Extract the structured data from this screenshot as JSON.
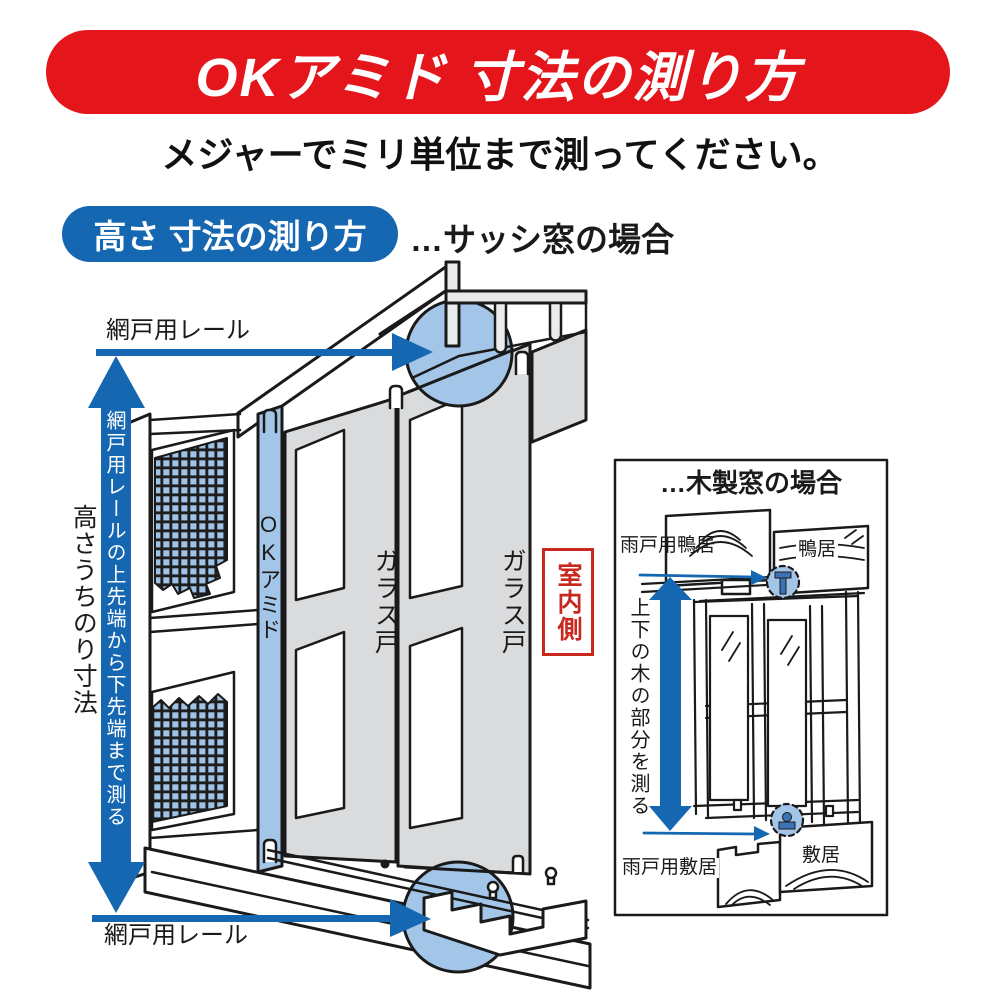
{
  "header": {
    "title": "OKアミド 寸法の測り方",
    "subtitle": "メジャーでミリ単位まで測ってください。"
  },
  "section": {
    "badge": "高さ 寸法の測り方",
    "case_label": "…サッシ窓の場合"
  },
  "sash": {
    "rail_label_top": "網戸用レール",
    "rail_label_bottom": "網戸用レール",
    "measure_note": "網戸用レールの上先端から下先端まで測る",
    "height_label": "高さうちのり寸法",
    "screen_label": "OKアミド",
    "glass_door_1": "ガラス戸",
    "glass_door_2": "ガラス戸",
    "indoor_label": "室内側"
  },
  "wood": {
    "title": "…木製窓の場合",
    "top_left_label": "雨戸用鴨居",
    "top_right_label": "鴨居",
    "measure_note": "上下の木の部分を測る",
    "bottom_left_label": "雨戸用敷居",
    "bottom_right_label": "敷居"
  },
  "colors": {
    "banner_red": "#e4151b",
    "accent_blue": "#1567b2",
    "highlight_blue": "#a3c6e8",
    "panel_gray": "#d9dbdd",
    "indoor_red": "#c8281e",
    "line_black": "#1a1a1a"
  }
}
